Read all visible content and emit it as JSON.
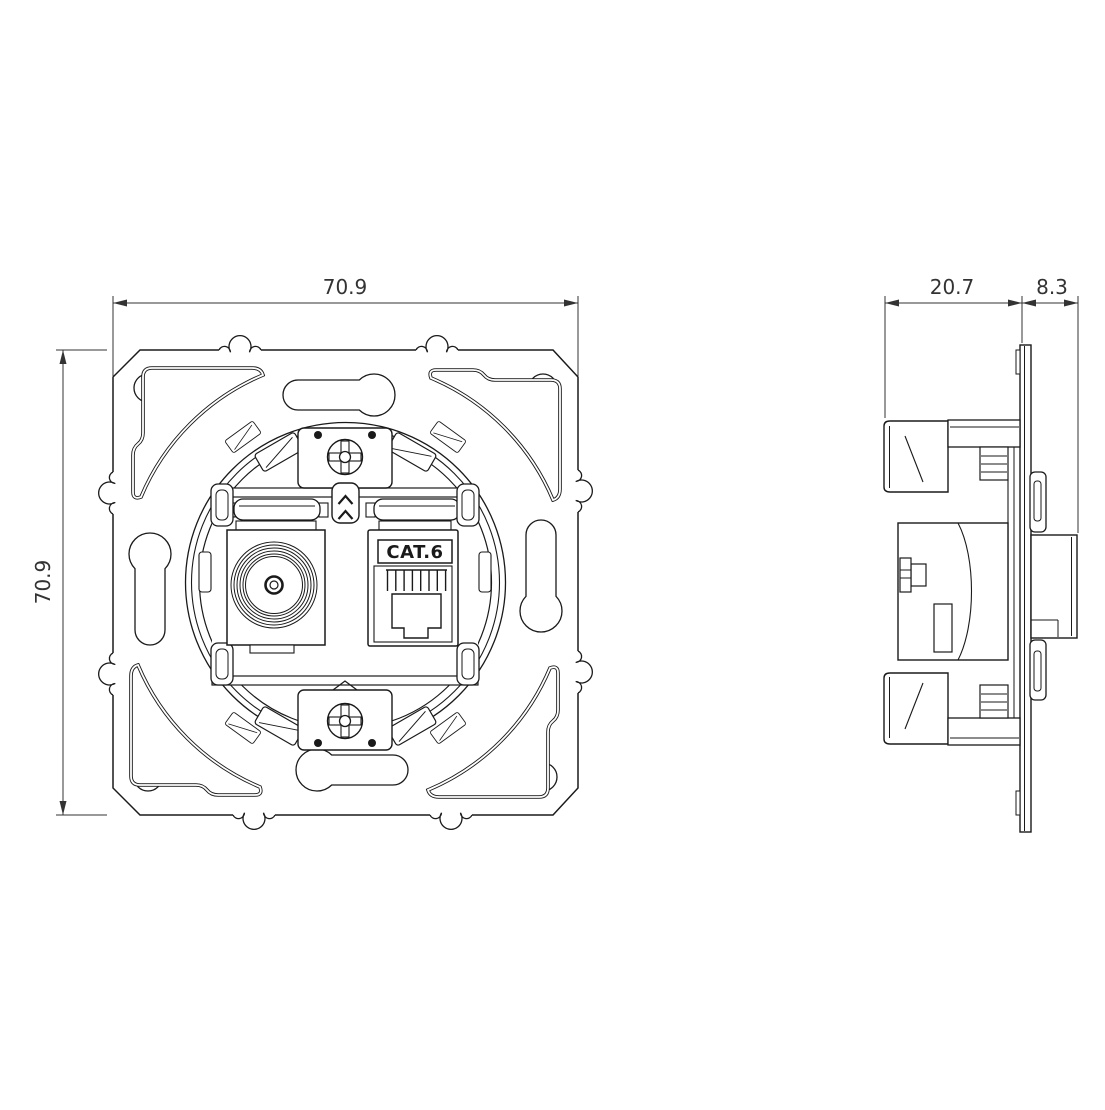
{
  "colors": {
    "background": "#ffffff",
    "line": "#1a1a1a",
    "dim": "#333333"
  },
  "front_view": {
    "width_dim": "70.9",
    "height_dim": "70.9",
    "rj45_label": "CAT.6"
  },
  "side_view": {
    "depth_dim": "20.7",
    "protrusion_dim": "8.3"
  }
}
